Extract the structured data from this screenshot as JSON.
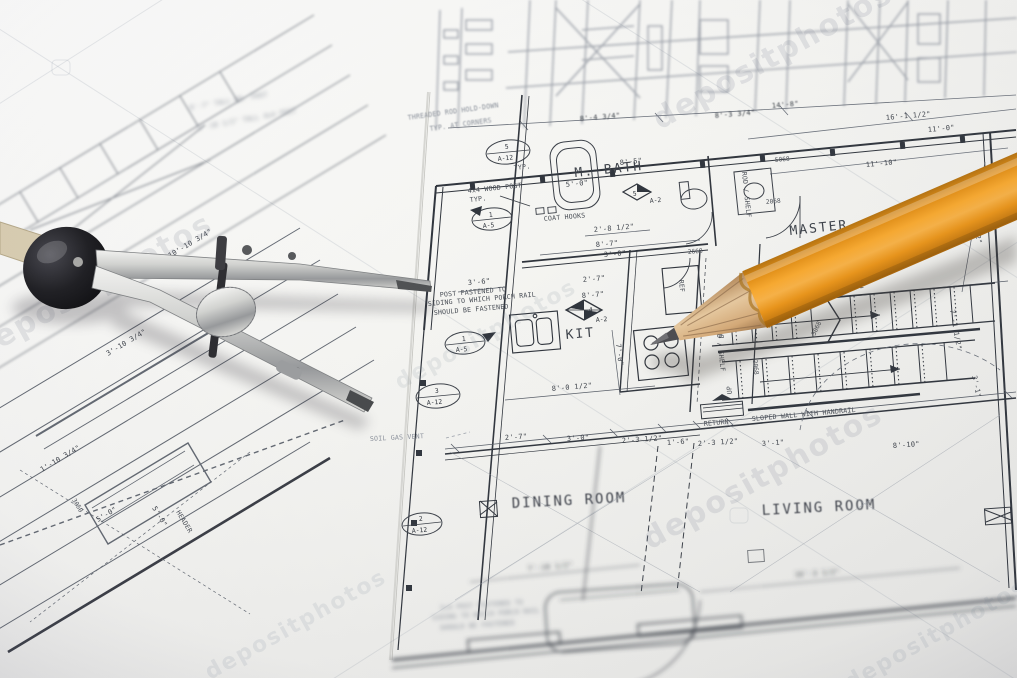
{
  "scene": {
    "subject": "architectural floor plan blueprints with drafting compass and orange pencil",
    "watermark": "depositphotos"
  },
  "colors": {
    "paper": "#f4f4f1",
    "ink": "#3a3f47",
    "ink_faint": "#9ba1aa",
    "pencil_body": "#f09d23",
    "pencil_wood": "#cba47d",
    "pencil_graphite": "#4b4b4f",
    "compass_metal": "#c9cbc9",
    "compass_knob": "#1b1b1e"
  },
  "rooms": {
    "m_bath": "M. BATH",
    "kit": "KIT",
    "master": "MASTER",
    "dining": "DINING ROOM",
    "living": "LIVING ROOM"
  },
  "notes": {
    "threaded_rod": "THREADED ROD HOLD-DOWN",
    "at_corners": "TYP. AT CORNERS",
    "wood_post": "4x4 WOOD POST",
    "typ": "TYP.",
    "coat_hooks": "COAT HOOKS",
    "post_note1": "POST FASTENED TO",
    "post_note2": "SIDING TO WHICH PORCH RAIL",
    "post_note3": "SHOULD BE FASTENED",
    "soil_gas": "SOIL GAS VENT",
    "return_duct": "RETURN",
    "rod_shelf": "ROD / SHELF",
    "sloped_wall": "SLOPED WALL WITH HANDRAIL",
    "dn": "DN",
    "up": "UP",
    "ref": "REF",
    "header": "HEADER",
    "tall_post1": "8'-7\" TALL WD. POST",
    "tall_post2": "6'-10 1/2\" TALL 4x4 POST",
    "post_note_b1": "2x4 POST FASTENED TO",
    "post_note_b2": "SIDING TO WHICH PORCH RAIL",
    "post_note_b3": "SHOULD BE FASTENED"
  },
  "markers": {
    "m1num": "1",
    "m1sheet": "A-5",
    "m2num": "3",
    "m2sheet": "A-12",
    "m3num": "5",
    "m3sheet": "A-12",
    "m4num": "2",
    "m4sheet": "A-12",
    "m5left": "3",
    "m5right": "4",
    "m5sheet": "A-2",
    "m6num": "5",
    "m6sheet": "A-2",
    "m7num": "1",
    "m7sheet": "A-5"
  },
  "doors": {
    "d1": "2068",
    "d2": "2668",
    "d3": "5068",
    "d4": "3068",
    "d5": "3050",
    "d7": "2668",
    "d8": "2068"
  },
  "dims": {
    "a1": "8'-5\"",
    "a2": "5'-0\"",
    "a3": "2'-8 1/2\"",
    "a4": "8'-7\"",
    "a5": "3'-0\"",
    "a6": "3'-6\"",
    "a7": "2'-7\"",
    "a8": "8'-7\"",
    "a9": "8'-0 1/2\"",
    "a10": "7'-0\"",
    "a11": "14'-2 1/2\"",
    "a12": "13'-4 1/2\"",
    "a13": "16'-1 1/2\"",
    "a14": "11'-10\"",
    "a15": "11'-0\"",
    "b1": "2'-7\"",
    "b2": "3'-0\"",
    "b3": "2'-3 1/2\"",
    "b4": "1'-6\"",
    "b5": "2'-3 1/2\"",
    "b6": "3'-1\"",
    "b7": "8'-10\"",
    "c1": "16'-3 1/2\"",
    "c2": "7'-10 1/2\"",
    "c3": "7'-1 1/2\"",
    "c4": "3'-1\"",
    "d1": "10'-10 3/4\"",
    "d2": "3'-10 3/4\"",
    "d3": "1'-10 3/4\"",
    "d4": "5'-0\"",
    "d5": "5'-0\"",
    "e1": "8'-4 3/4\"",
    "e2": "8'-3 3/4\"",
    "e3": "14'-8\""
  }
}
